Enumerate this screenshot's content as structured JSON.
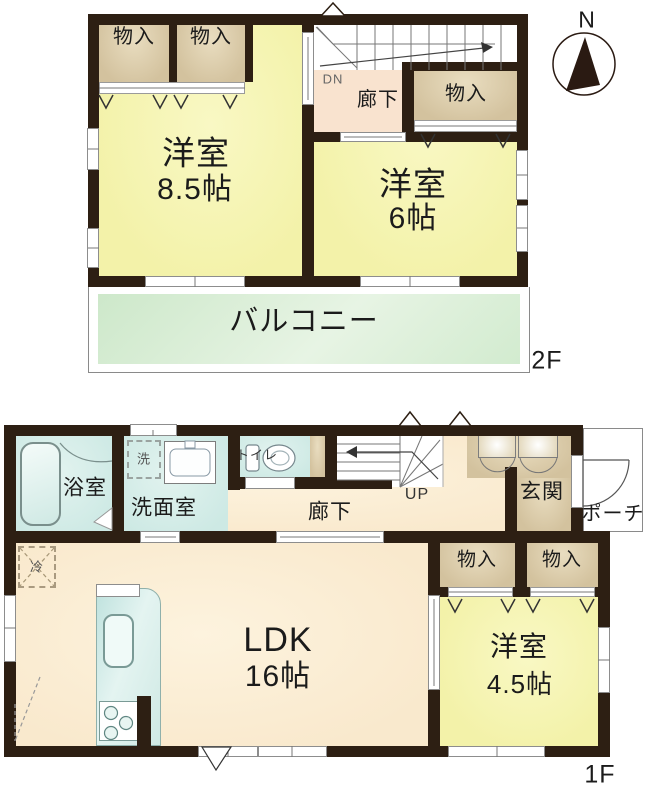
{
  "colors": {
    "wall": "#2d1f13",
    "roomYellow": "#f3f2a9",
    "closetTan": "#d3c29e",
    "hallPeach": "#f9e9cd",
    "hallPink": "#f9e3cf",
    "balconyGreen": "#d6ecd3",
    "wetBlue": "#cde9e4"
  },
  "compass": {
    "north": "N"
  },
  "floor2": {
    "label": "2F",
    "closet_a": "物入",
    "closet_b": "物入",
    "closet_c": "物入",
    "dn": "DN",
    "hallway": "廊下",
    "room1_name": "洋室",
    "room1_size": "8.5帖",
    "room2_name": "洋室",
    "room2_size": "6帖",
    "balcony": "バルコニー"
  },
  "floor1": {
    "label": "1F",
    "bath": "浴室",
    "laundry": "洗",
    "washroom": "洗面室",
    "toilet": "トイレ",
    "hallway": "廊下",
    "up": "UP",
    "entrance": "玄関",
    "porch": "ポーチ",
    "fridge": "冷",
    "ldk_name": "LDK",
    "ldk_size": "16帖",
    "closet_a": "物入",
    "closet_b": "物入",
    "room_name": "洋室",
    "room_size": "4.5帖"
  }
}
